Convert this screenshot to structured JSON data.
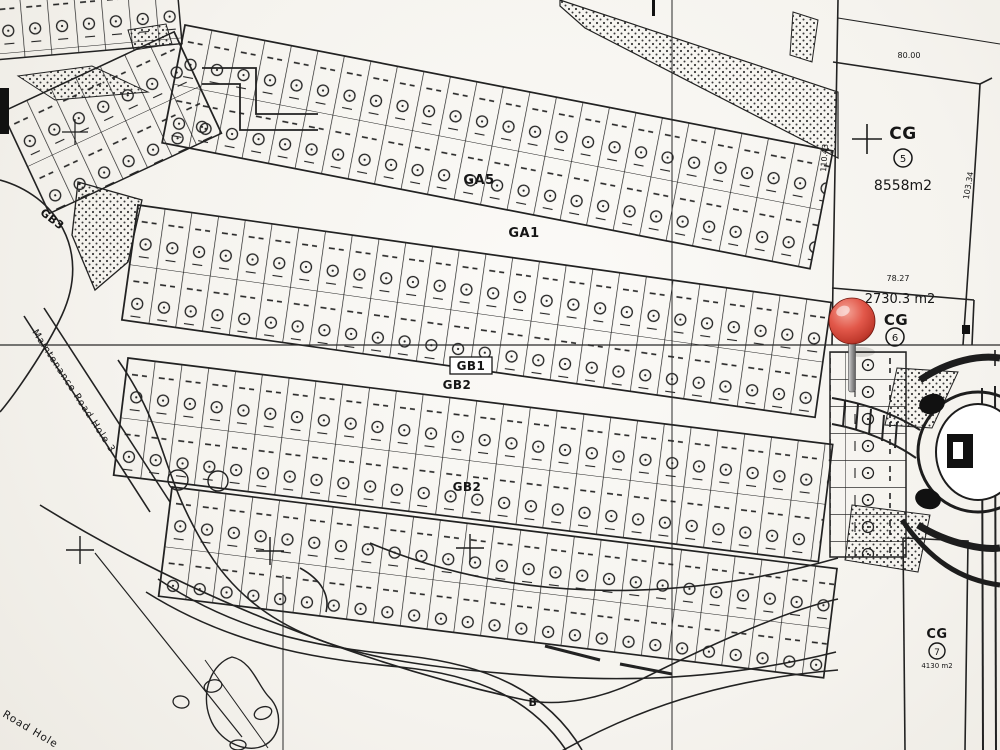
{
  "map": {
    "parcels": {
      "cg5": {
        "code": "CG",
        "number": "5",
        "area": "8558m2"
      },
      "cg6": {
        "code": "CG",
        "number": "6",
        "area": "2730.3 m2"
      },
      "cg7": {
        "code": "CG",
        "number": "7",
        "area": "4130 m2"
      }
    },
    "zones": {
      "ga5": "GA5",
      "ga1": "GA1",
      "gb1": "GB1",
      "gb2_upper": "GB2",
      "gb2_lower": "GB2",
      "gb3": "GB3"
    },
    "roads": {
      "maintenance_road": "Maintenance Road Hole 3",
      "bottom_left_road": "Road Hole"
    },
    "measurements": {
      "cg5_top": "80.00",
      "cg5_left": "110.43",
      "cg5_right": "103.34",
      "cg6_top": "78.27"
    },
    "annotations": {
      "point_b": "B"
    },
    "marker": {
      "type": "red-pushpin",
      "ball_color": "#d7473b",
      "needle_color": "#9b9b9b"
    },
    "colors": {
      "paper": "#f7f6f2",
      "ink": "#222222"
    }
  }
}
